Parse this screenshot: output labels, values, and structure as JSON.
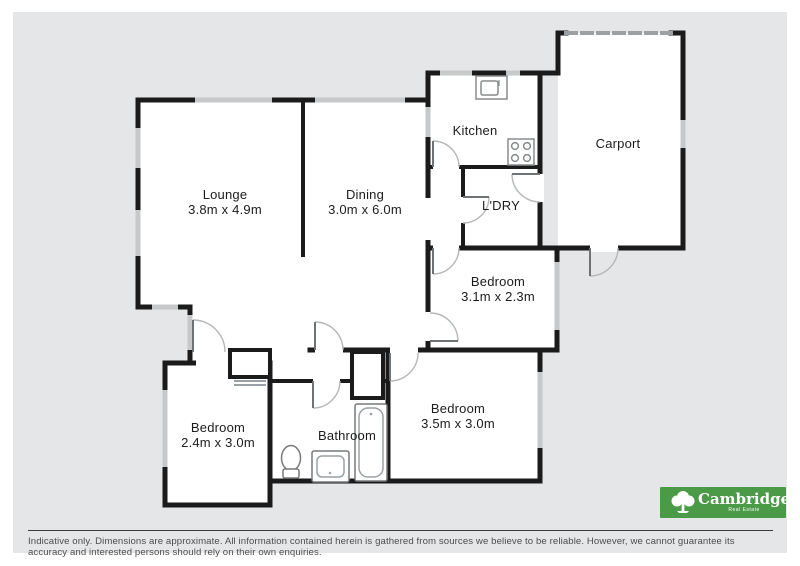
{
  "floorplan": {
    "rooms": [
      {
        "name": "Lounge",
        "dims": "3.8m x 4.9m"
      },
      {
        "name": "Dining",
        "dims": "3.0m x 6.0m"
      },
      {
        "name": "Kitchen",
        "dims": ""
      },
      {
        "name": "Carport",
        "dims": ""
      },
      {
        "name": "L'DRY",
        "dims": ""
      },
      {
        "name": "Bedroom",
        "dims": "3.1m x 2.3m"
      },
      {
        "name": "Bedroom",
        "dims": "2.4m x 3.0m"
      },
      {
        "name": "Bathroom",
        "dims": ""
      },
      {
        "name": "Bedroom",
        "dims": "3.5m x 3.0m"
      }
    ],
    "fixtures": [
      "kitchen-sink",
      "cooktop",
      "toilet",
      "vanity",
      "bathtub"
    ]
  },
  "footer": {
    "disclaimer": "Indicative only. Dimensions are approximate. All information contained herein is gathered from sources we believe to be reliable. However, we cannot guarantee its accuracy and interested persons should rely on their own enquiries."
  },
  "logo": {
    "brand": "Cambridge",
    "tagline": "Real Estate"
  },
  "colors": {
    "background": "#e5e6e7",
    "wall": "#1b1b1b",
    "window": "#c6c8ca",
    "logo_green": "#4a9a47"
  }
}
